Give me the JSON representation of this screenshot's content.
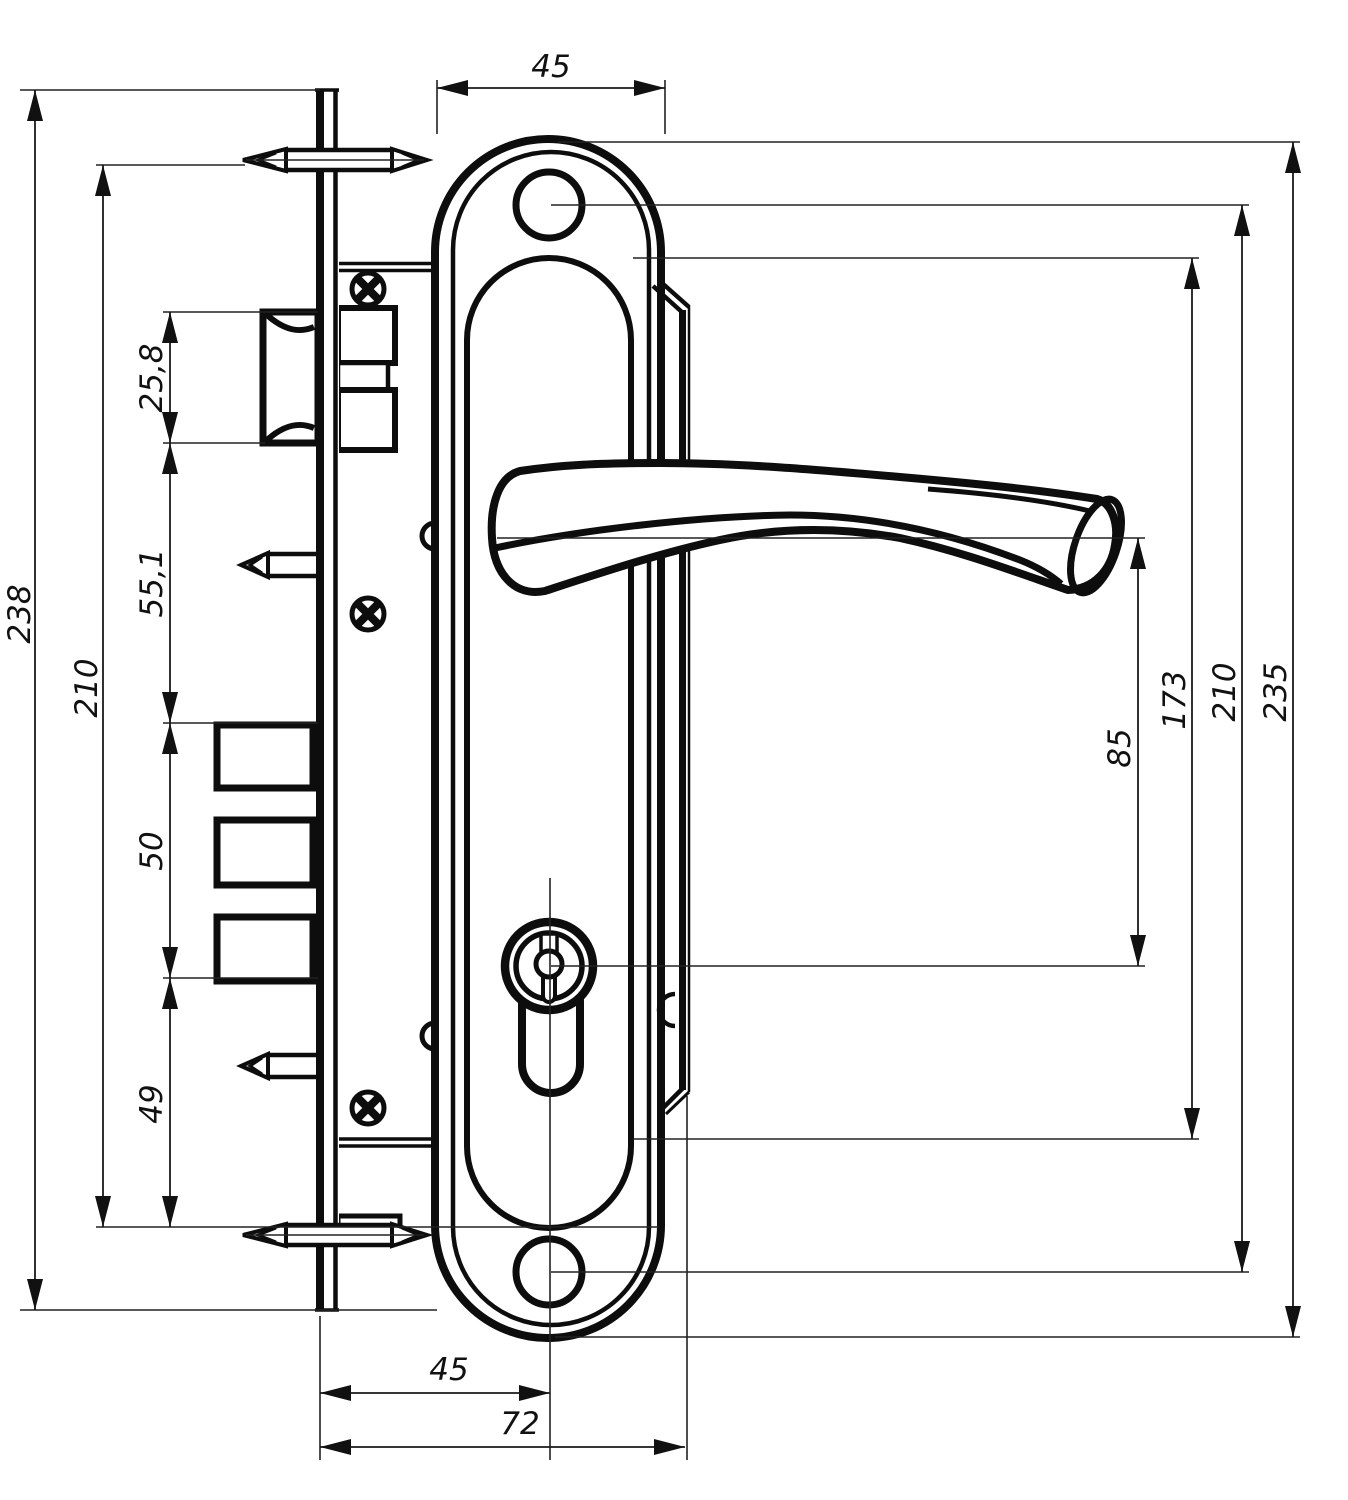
{
  "title": "door-lock-mortise-and-handle-technical-drawing",
  "colors": {
    "ink": "#0d0d0d",
    "background": "#ffffff"
  },
  "dims": {
    "top": {
      "plate_width": "45"
    },
    "left": {
      "overall_height": "238",
      "mount_pin_span": "210",
      "latch_height": "25,8",
      "latch_to_deadbolt": "55,1",
      "deadbolt_span": "50",
      "deadbolt_to_base": "49"
    },
    "right": {
      "handle_to_cylinder": "85",
      "case_height": "173",
      "screw_hole_spacing": "210",
      "plate_height": "235"
    },
    "bottom": {
      "backset": "45",
      "overall_depth": "72"
    }
  }
}
